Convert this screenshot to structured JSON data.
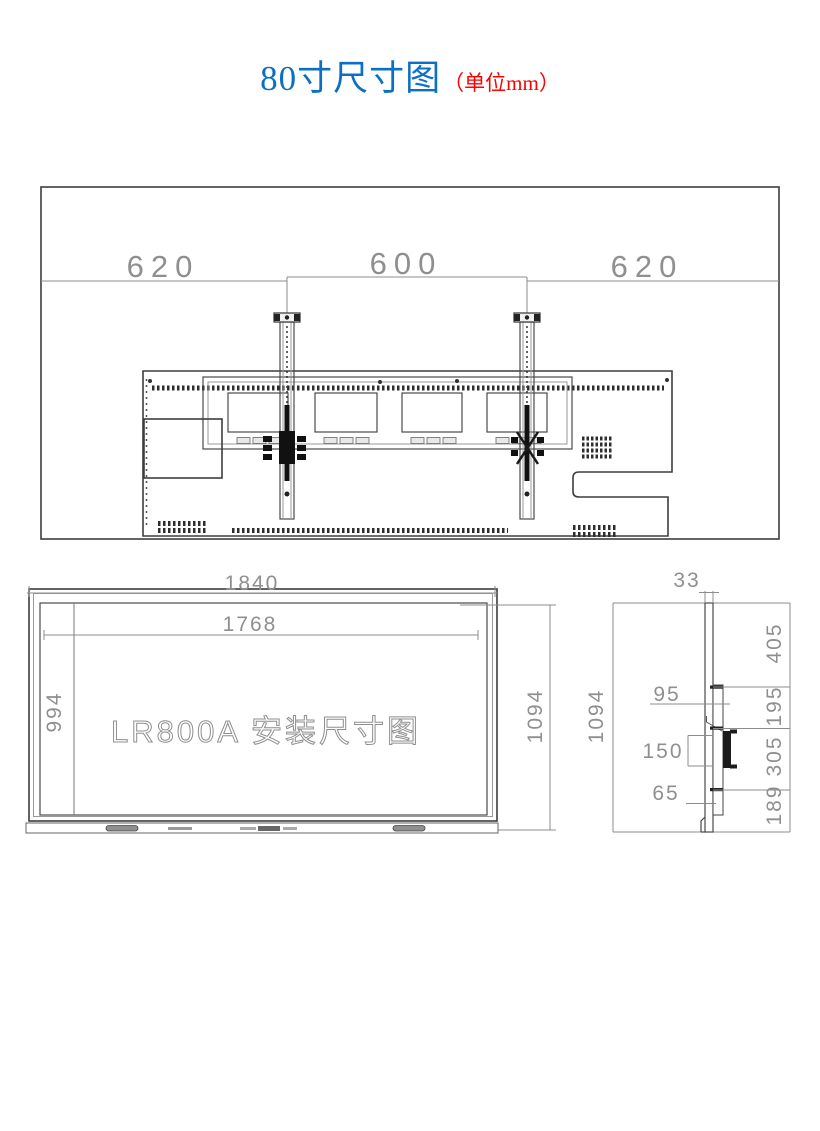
{
  "title": {
    "text": "80寸尺寸图",
    "unit_note": "（单位mm）"
  },
  "model_label": "LR800A 安装尺寸图",
  "dimensions": {
    "top_view": {
      "left_wall_offset": "620",
      "rail_spacing": "600",
      "right_wall_offset": "620"
    },
    "front_view": {
      "overall_width": "1840",
      "screen_width": "1768",
      "screen_height": "994",
      "overall_height": "1094"
    },
    "side_view": {
      "panel_thickness": "33",
      "overall_height": "1094",
      "seg_top": "405",
      "hook_inset": "95",
      "seg_upper": "195",
      "hook_spacing": "150",
      "seg_middle": "305",
      "bottom_inset": "65",
      "seg_bottom": "189"
    }
  },
  "colors": {
    "title_blue": "#0b70c5",
    "unit_red": "#ff0000",
    "line_dark": "#3d3d3d",
    "dim_line": "#8c8c8c",
    "dim_text": "#8f8f8f"
  }
}
